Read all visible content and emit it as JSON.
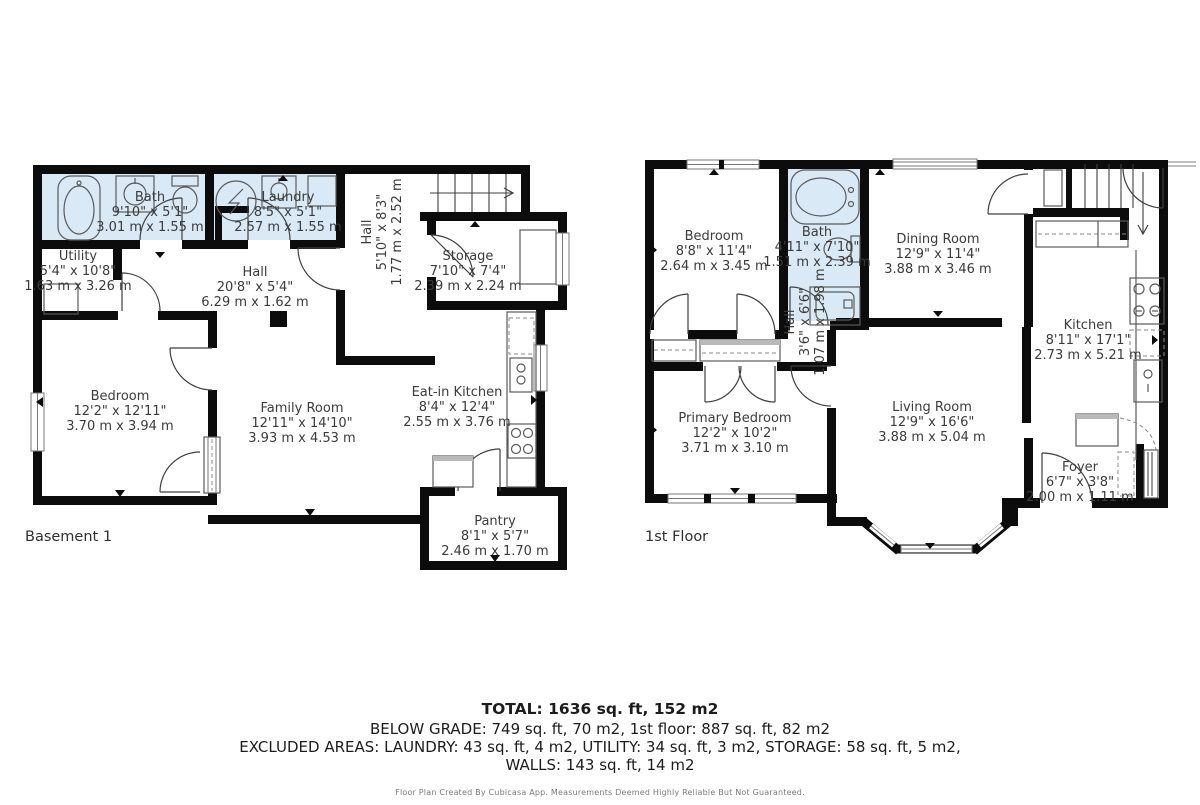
{
  "floors": {
    "basement": {
      "label": "Basement 1",
      "rooms": [
        {
          "name": "Bath",
          "dim_ft": "9'10\" x 5'1\"",
          "dim_m": "3.01 m x 1.55 m"
        },
        {
          "name": "Laundry",
          "dim_ft": "8'5\" x 5'1\"",
          "dim_m": "2.57 m x 1.55 m"
        },
        {
          "name": "Utility",
          "dim_ft": "5'4\" x 10'8\"",
          "dim_m": "1.63 m x 3.26 m"
        },
        {
          "name": "Hall",
          "dim_ft": "20'8\" x 5'4\"",
          "dim_m": "6.29 m x 1.62 m"
        },
        {
          "name": "Hall",
          "dim_ft": "5'10\" x 8'3\"",
          "dim_m": "1.77 m x 2.52 m"
        },
        {
          "name": "Storage",
          "dim_ft": "7'10\" x 7'4\"",
          "dim_m": "2.39 m x 2.24 m"
        },
        {
          "name": "Bedroom",
          "dim_ft": "12'2\" x 12'11\"",
          "dim_m": "3.70 m x 3.94 m"
        },
        {
          "name": "Family Room",
          "dim_ft": "12'11\" x 14'10\"",
          "dim_m": "3.93 m x 4.53 m"
        },
        {
          "name": "Eat-in Kitchen",
          "dim_ft": "8'4\" x 12'4\"",
          "dim_m": "2.55 m x 3.76 m"
        },
        {
          "name": "Pantry",
          "dim_ft": "8'1\" x 5'7\"",
          "dim_m": "2.46 m x 1.70 m"
        }
      ]
    },
    "first": {
      "label": "1st Floor",
      "rooms": [
        {
          "name": "Bedroom",
          "dim_ft": "8'8\" x 11'4\"",
          "dim_m": "2.64 m x 3.45 m"
        },
        {
          "name": "Bath",
          "dim_ft": "4'11\" x 7'10\"",
          "dim_m": "1.51 m x 2.39 m"
        },
        {
          "name": "Dining Room",
          "dim_ft": "12'9\" x 11'4\"",
          "dim_m": "3.88 m x 3.46 m"
        },
        {
          "name": "Kitchen",
          "dim_ft": "8'11\" x 17'1\"",
          "dim_m": "2.73 m x 5.21 m"
        },
        {
          "name": "Hall",
          "dim_ft": "3'6\" x 6'6\"",
          "dim_m": "1.07 m x 1.98 m"
        },
        {
          "name": "Primary Bedroom",
          "dim_ft": "12'2\" x 10'2\"",
          "dim_m": "3.71 m x 3.10 m"
        },
        {
          "name": "Living Room",
          "dim_ft": "12'9\" x 16'6\"",
          "dim_m": "3.88 m x 5.04 m"
        },
        {
          "name": "Foyer",
          "dim_ft": "6'7\" x 3'8\"",
          "dim_m": "2.00 m x 1.11 m"
        }
      ]
    }
  },
  "summary": {
    "total": "TOTAL: 1636 sq. ft, 152 m2",
    "below_grade": "BELOW GRADE: 749 sq. ft, 70 m2, 1st floor: 887 sq. ft, 82 m2",
    "excluded": "EXCLUDED AREAS: LAUNDRY: 43 sq. ft, 4 m2, UTILITY: 34 sq. ft, 3 m2, STORAGE: 58 sq. ft, 5 m2,",
    "walls": "WALLS: 143 sq. ft, 14 m2",
    "disclaimer": "Floor Plan Created By Cubicasa App. Measurements Deemed Highly Reliable But Not Guaranteed."
  },
  "colors": {
    "wall": "#0c0c0c",
    "wet_room_fill": "#d9eaf6",
    "label_text": "#3b3b3b",
    "background": "#ffffff"
  }
}
